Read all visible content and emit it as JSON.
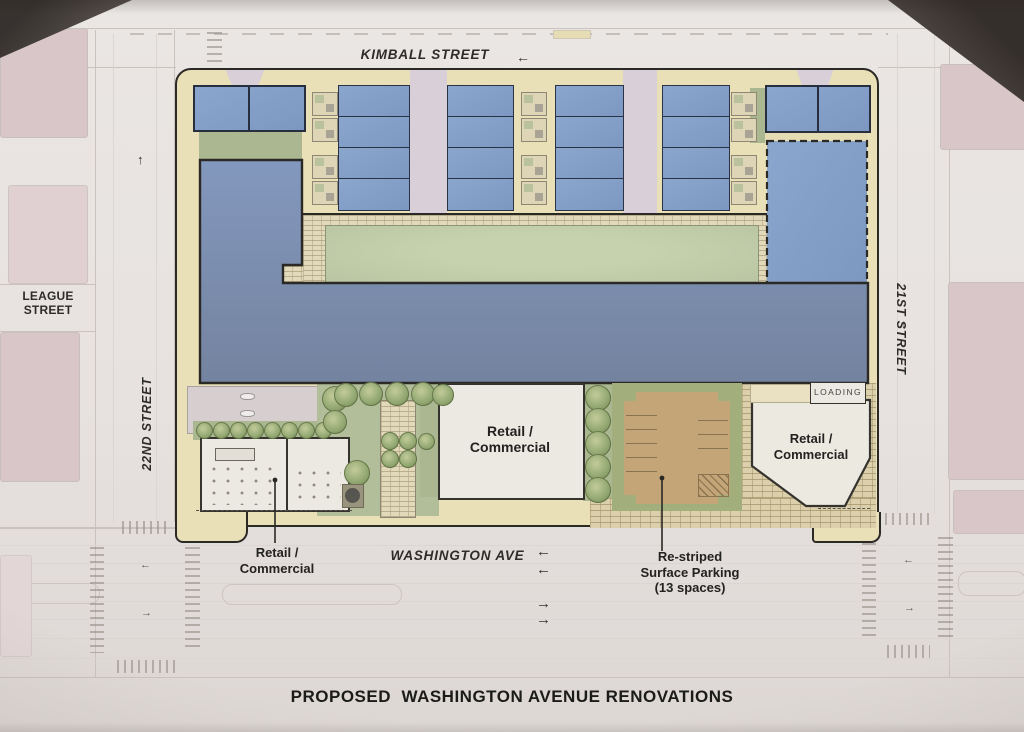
{
  "document": {
    "title": "PROPOSED  WASHINGTON AVENUE RENOVATIONS"
  },
  "streets": {
    "kimball": "KIMBALL STREET",
    "league": "LEAGUE STREET",
    "twenty_second": "22ND STREET",
    "twenty_first": "21ST STREET",
    "washington": "WASHINGTON AVE"
  },
  "site": {
    "loading_label": "LOADING",
    "retail_center": "Retail /\nCommercial",
    "retail_right": "Retail /\nCommercial",
    "retail_bottom": "Retail /\nCommercial",
    "parking_note": "Re-striped\nSurface Parking\n(13 spaces)"
  },
  "icons": {
    "arrow_left": "←",
    "arrow_right": "→",
    "arrow_up": "↑",
    "arrow_down": "↓"
  },
  "colors": {
    "building_blue": "#7E94BB",
    "townhouse_blue": "#84A0C9",
    "courtyard_green": "#BFCAA8",
    "lawn_green": "#B2BE9A",
    "sidewalk_tan": "#E9E0B8",
    "parking_tan": "#C3A577",
    "parking_green": "#A2AE7B",
    "walkway_lavender": "#D8CFD8",
    "block_pink": "#D9C6C8",
    "plaza_brick": "#DCD1AD",
    "line_dark": "#2E2C28",
    "paper": "#E7E2E0"
  }
}
